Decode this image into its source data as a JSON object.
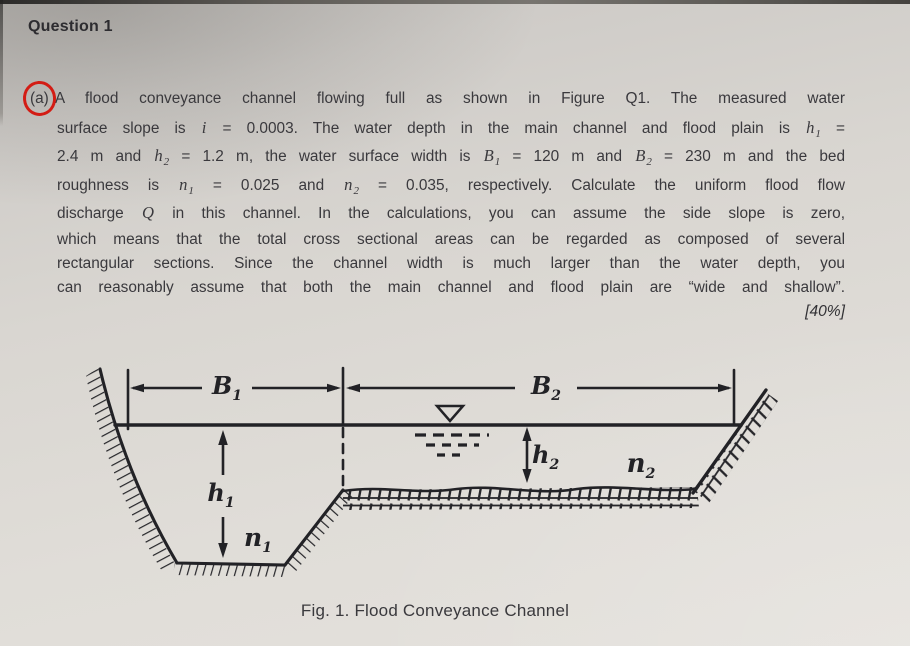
{
  "document": {
    "title": "Question 1",
    "part_label": "(a)",
    "marks": "[40%]",
    "caption": "Fig. 1. Flood Conveyance Channel",
    "paragraph": {
      "lines": [
        [
          {
            "t": "A flood conveyance channel flowing full as shown in Figure Q1. The measured water"
          }
        ],
        [
          {
            "t": "surface slope is "
          },
          {
            "v": "i"
          },
          {
            "t": " = 0.0003. The water depth in the main channel and flood plain is "
          },
          {
            "v": "h",
            "s": "1"
          },
          {
            "t": " ="
          }
        ],
        [
          {
            "t": "2.4 m and "
          },
          {
            "v": "h",
            "s": "2"
          },
          {
            "t": " = 1.2 m, the water surface width is "
          },
          {
            "v": "B",
            "s": "1"
          },
          {
            "t": " = 120 m and "
          },
          {
            "v": "B",
            "s": "2"
          },
          {
            "t": " = 230 m and the bed"
          }
        ],
        [
          {
            "t": "roughness is "
          },
          {
            "v": "n",
            "s": "1"
          },
          {
            "t": " = 0.025 and "
          },
          {
            "v": "n",
            "s": "2"
          },
          {
            "t": " = 0.035, respectively. Calculate the uniform flood flow"
          }
        ],
        [
          {
            "t": "discharge "
          },
          {
            "v": "Q"
          },
          {
            "t": " in this channel. In the calculations, you can assume the side slope is zero,"
          }
        ],
        [
          {
            "t": "which means that the total cross sectional areas can be regarded as composed of several"
          }
        ],
        [
          {
            "t": "rectangular sections. Since the channel width is much larger than the water depth, you"
          }
        ],
        [
          {
            "t": "can reasonably assume that both the main channel and flood plain are “wide and shallow”."
          }
        ]
      ]
    }
  },
  "figure": {
    "labels": {
      "B1": {
        "base": "B",
        "sub": "1"
      },
      "B2": {
        "base": "B",
        "sub": "2"
      },
      "h1": {
        "base": "h",
        "sub": "1"
      },
      "h2": {
        "base": "h",
        "sub": "2"
      },
      "n1": {
        "base": "n",
        "sub": "1"
      },
      "n2": {
        "base": "n",
        "sub": "2"
      }
    },
    "icons": {
      "water_level": "▽"
    }
  },
  "colors": {
    "paper": "#dcd9d4",
    "ink": "#222226",
    "text": "#3a393d",
    "red_circle": "#d31c14"
  }
}
